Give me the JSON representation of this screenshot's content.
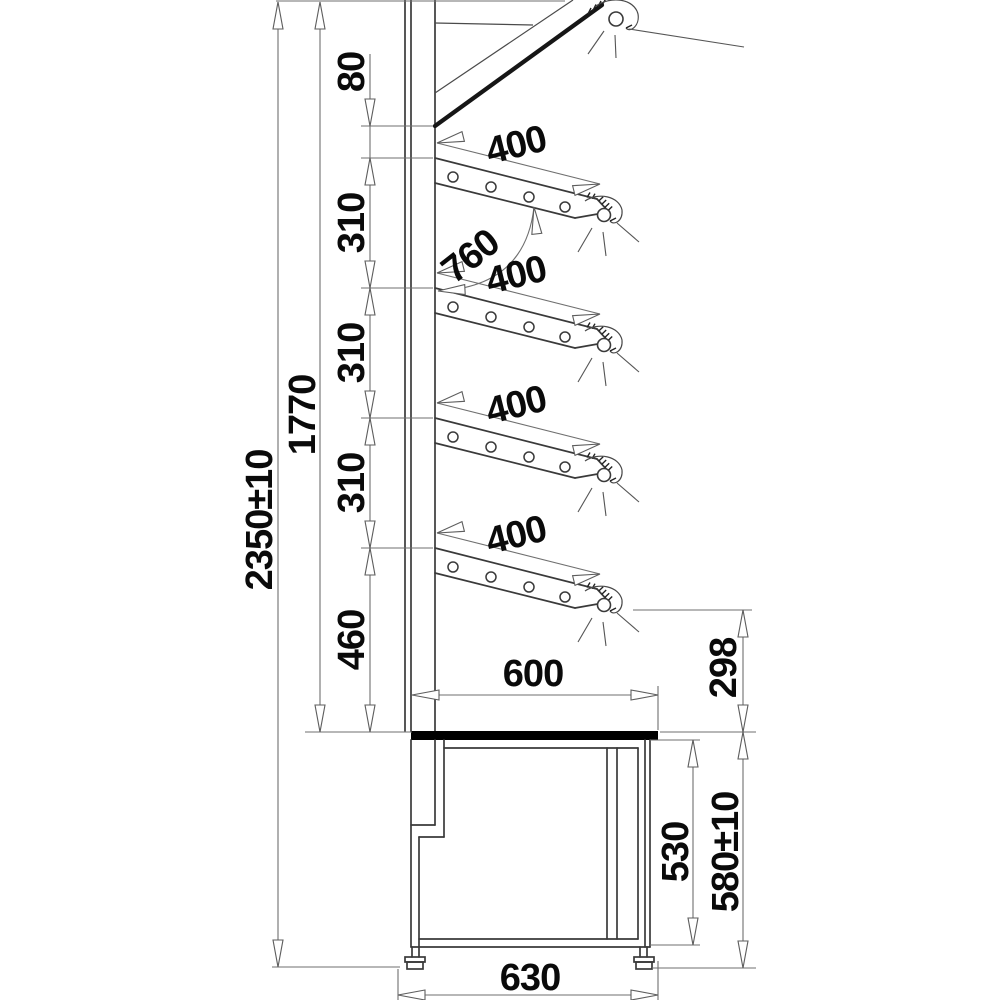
{
  "dimensions": {
    "overall_height": "2350±10",
    "inner_height": "1770",
    "gap_top": "80",
    "pitch1": "310",
    "pitch2": "310",
    "pitch3": "310",
    "gap_bottom": "460",
    "shelf1_depth": "400",
    "shelf2_depth": "400",
    "shelf3_depth": "400",
    "shelf4_depth": "400",
    "opening": "760",
    "counter_depth": "600",
    "front_height": "298",
    "base_inner_height": "530",
    "base_height": "580±10",
    "base_depth": "630"
  }
}
